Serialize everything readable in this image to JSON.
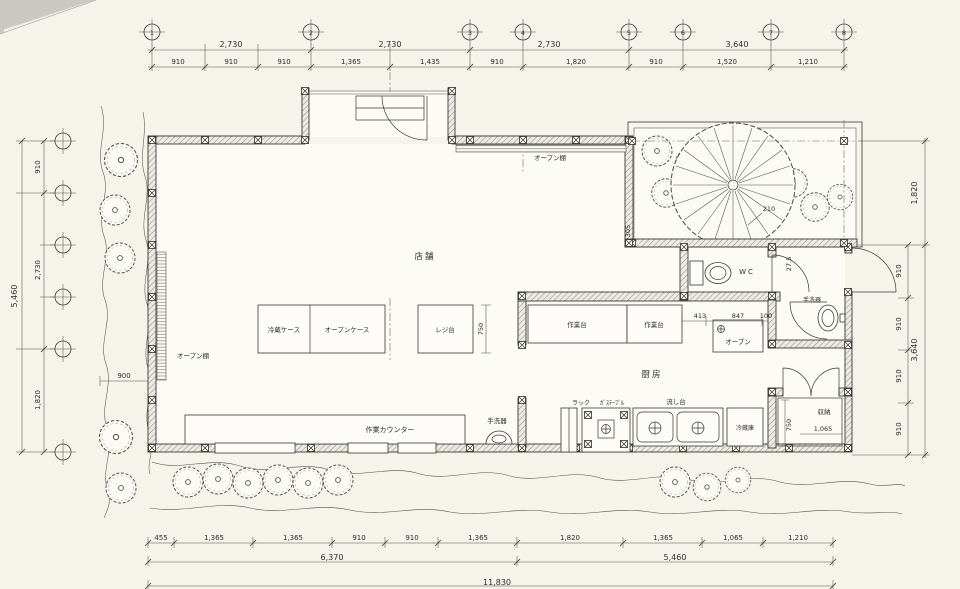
{
  "meta": {
    "drawing_type": "Japanese shop floor plan (平面図)"
  },
  "grid": {
    "top": [
      "1",
      "2",
      "3",
      "4",
      "5",
      "6",
      "7",
      "8"
    ]
  },
  "dims": {
    "top1": [
      "2,730",
      "2,730",
      "2,730",
      "3,640"
    ],
    "top2": [
      "910",
      "910",
      "910",
      "1,365",
      "1,435",
      "910",
      "1,820",
      "910",
      "1,520",
      "1,210"
    ],
    "left": {
      "overall": "5,460",
      "segs": [
        "910",
        "2,730",
        "1,820"
      ],
      "extra": "900"
    },
    "right": {
      "garden": "1,820",
      "overall": "3,640",
      "segs": [
        "910",
        "910",
        "910",
        "910"
      ],
      "gap": "27.5",
      "gap2": "305"
    },
    "bottom1": [
      "455",
      "1,365",
      "1,365",
      "910",
      "910",
      "1,365",
      "1,820",
      "1,365",
      "1,065",
      "1,210"
    ],
    "bottom2": [
      "6,370",
      "5,460"
    ],
    "bottom3": "11,830",
    "inner": {
      "island_depth": "750",
      "counter": [
        "413",
        "847",
        "100"
      ],
      "storage_depth": "750",
      "storage_width": "1,065",
      "tree": "210"
    }
  },
  "labels": {
    "shop": "店舗",
    "kitchen": "厨房",
    "wc": "WC",
    "oven": "オーブン",
    "open_shelf_top": "オープン棚",
    "open_shelf_left": "オープン棚",
    "fridge_case": "冷蔵ケース",
    "open_case": "オープンケース",
    "register": "レジ台",
    "work_counter": "作業カウンター",
    "hand_basin_1": "手洗器",
    "hand_basin_2": "手洗器",
    "work_table_1": "作業台",
    "work_table_2": "作業台",
    "rack": "ラック",
    "gas_table": "ｶﾞｽﾃｰﾌﾞﾙ",
    "sink": "流し台",
    "refrigerator": "冷蔵庫",
    "storage": "収納"
  }
}
